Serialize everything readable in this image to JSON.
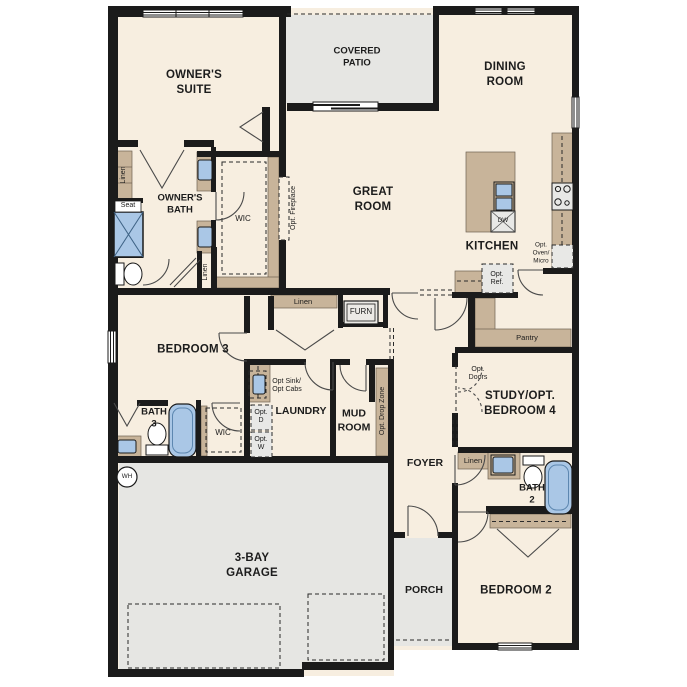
{
  "plan": {
    "rooms": {
      "owners_suite": "OWNER'S\nSUITE",
      "covered_patio": "COVERED\nPATIO",
      "dining_room": "DINING\nROOM",
      "great_room": "GREAT\nROOM",
      "kitchen": "KITCHEN",
      "owners_bath": "OWNER'S\nBATH",
      "wic_owners": "WIC",
      "bedroom_3": "BEDROOM 3",
      "bath_3": "BATH\n3",
      "wic_bath3": "WIC",
      "laundry": "LAUNDRY",
      "mud_room": "MUD\nROOM",
      "foyer": "FOYER",
      "study": "STUDY/OPT.\nBEDROOM 4",
      "bath_2": "BATH\n2",
      "bedroom_2": "BEDROOM 2",
      "porch": "PORCH",
      "garage": "3-BAY\nGARAGE",
      "pantry": "Pantry"
    },
    "closets": {
      "linen_owners": "Linen",
      "linen_wic": "Linen",
      "linen_hall": "Linen",
      "linen_bed2": "Linen"
    },
    "fixtures": {
      "seat": "Seat",
      "furn": "FURN",
      "dw": "DW",
      "wh": "WH"
    },
    "options": {
      "opt_fireplace": "Opt. Fireplace",
      "opt_oven_micro": "Opt.\nOven/\nMicro",
      "opt_ref": "Opt.\nRef.",
      "opt_sink_cabs": "Opt Sink/\nOpt Cabs",
      "opt_d": "Opt.\nD",
      "opt_w": "Opt.\nW",
      "opt_drop_zone": "Opt. Drop Zone",
      "opt_doors": "Opt.\nDoors"
    },
    "colors": {
      "floor": "#f7eee0",
      "wall": "#1b1b1b",
      "cabinet": "#c8b49a",
      "exterior": "#e6e6e3",
      "fixture_blue": "#aac7e6",
      "appliance": "#e8e8e6"
    }
  }
}
